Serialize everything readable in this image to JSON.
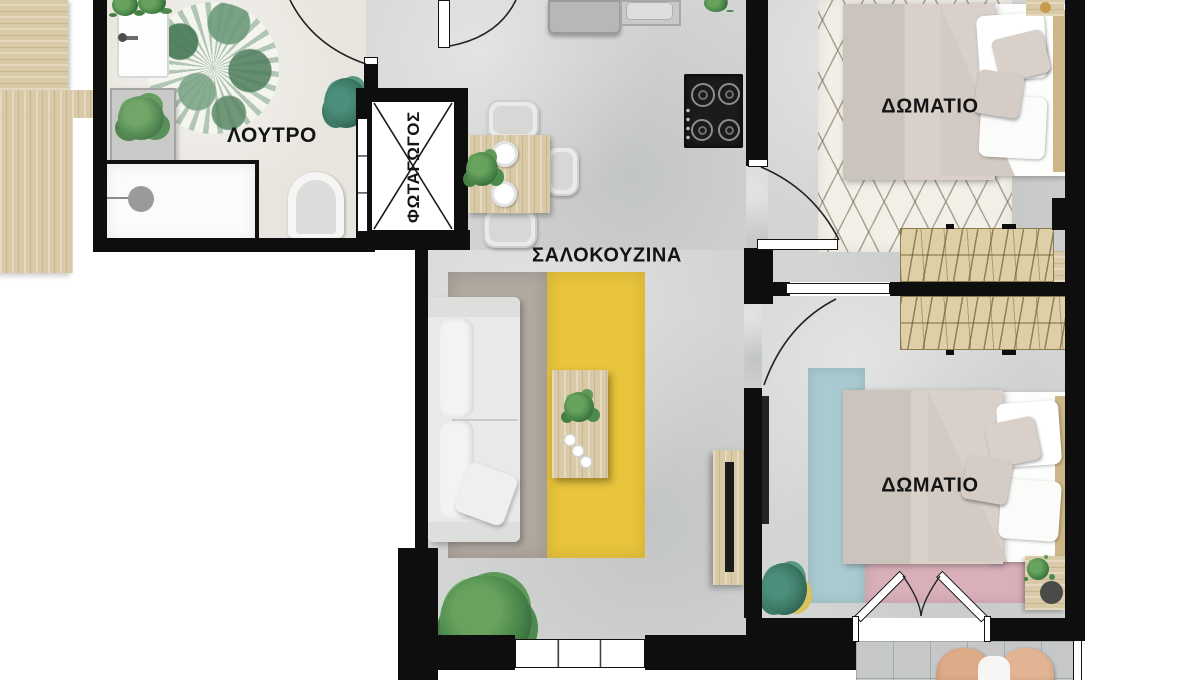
{
  "labels": {
    "bathroom": "ΛΟΥΤΡΟ",
    "lightwell": "ΦΩΤΑΓΩΓΟΣ",
    "living_kitchen": "ΣΑΛΟΚΟΥΖΙΝΑ",
    "bedroom1": "ΔΩΜΑΤΙΟ",
    "bedroom2": "ΔΩΜΑΤΙΟ"
  },
  "colors": {
    "wall": "#0e0e0e",
    "floor": "#d3d5d4",
    "floor_bath": "#e8e5de",
    "wood": "#d9caa7",
    "tile": "#c5c7c8",
    "rug_yellow": "#e9c53c",
    "rug_gray": "#b2a9a1",
    "rug_blue": "#a9cad0",
    "rug_pink": "#d9b0ba",
    "rug_diamond": "#f2efe7",
    "sofa": "#e9e9e7",
    "bed_blanket": "#d8d0c9",
    "hob": "#1b1b1b"
  }
}
